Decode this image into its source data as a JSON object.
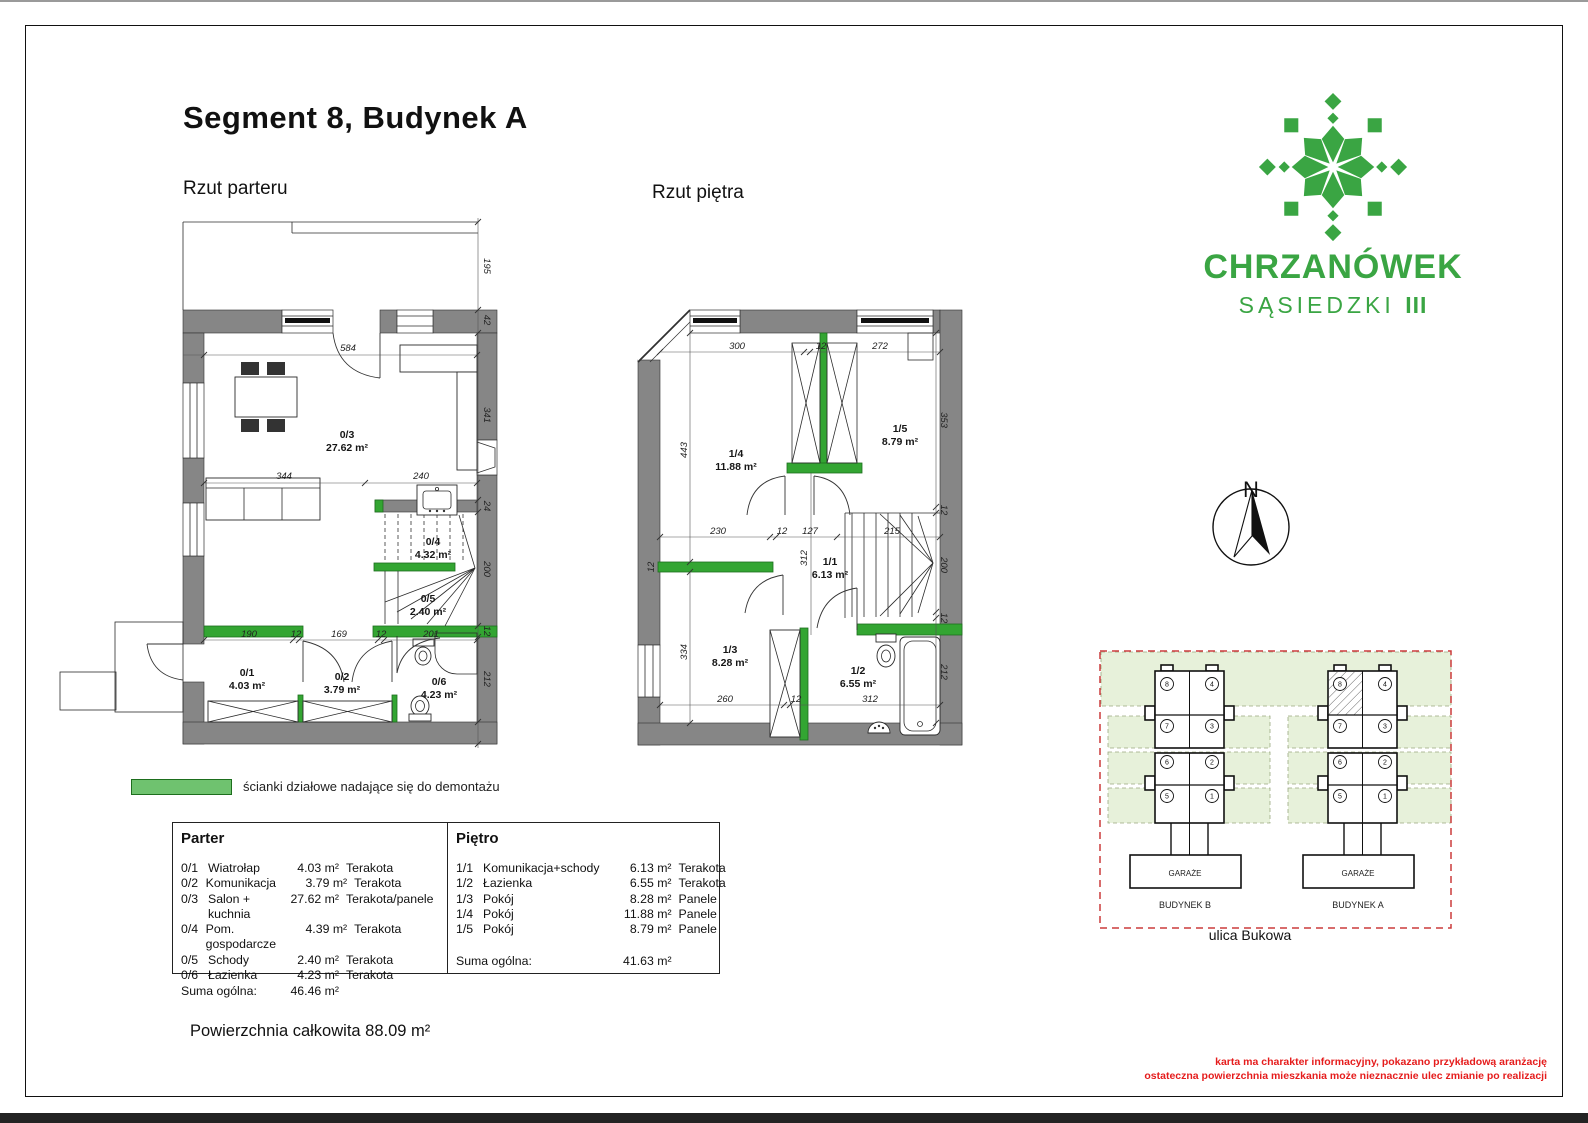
{
  "page": {
    "title": "Segment 8, Budynek A",
    "ground_label": "Rzut parteru",
    "upper_label": "Rzut piętra",
    "legend_text": "ścianki działowe nadające się do demontażu",
    "total_area": "Powierzchnia całkowita 88.09 m²",
    "disclaimer_line1": "karta ma charakter informacyjny, pokazano przykładową aranżację",
    "disclaimer_line2": "ostateczna powierzchnia mieszkania może nieznacznie ulec zmianie po realizacji"
  },
  "logo": {
    "name": "CHRZANÓWEK",
    "sub": "SĄSIEDZKI",
    "roman": "III",
    "green": "#3aa543"
  },
  "compass": {
    "north": "N"
  },
  "site": {
    "building_b": "BUDYNEK B",
    "building_a": "BUDYNEK A",
    "garage_label": "GARAŻE",
    "street": "ulica Bukowa",
    "units": [
      "8",
      "4",
      "7",
      "3",
      "6",
      "2",
      "5",
      "1"
    ]
  },
  "tables": {
    "parter": {
      "header": "Parter",
      "rows": [
        {
          "id": "0/1",
          "name": "Wiatrołap",
          "area": "4.03 m²",
          "floor": "Terakota"
        },
        {
          "id": "0/2",
          "name": "Komunikacja",
          "area": "3.79 m²",
          "floor": "Terakota"
        },
        {
          "id": "0/3",
          "name": "Salon + kuchnia",
          "area": "27.62 m²",
          "floor": "Terakota/panele"
        },
        {
          "id": "0/4",
          "name": "Pom. gospodarcze",
          "area": "4.39 m²",
          "floor": "Terakota"
        },
        {
          "id": "0/5",
          "name": "Schody",
          "area": "2.40 m²",
          "floor": "Terakota"
        },
        {
          "id": "0/6",
          "name": "Łazienka",
          "area": "4.23 m²",
          "floor": "Terakota"
        }
      ],
      "sum_label": "Suma ogólna:",
      "sum_value": "46.46 m²"
    },
    "pietro": {
      "header": "Piętro",
      "rows": [
        {
          "id": "1/1",
          "name": "Komunikacja+schody",
          "area": "6.13 m²",
          "floor": "Terakota"
        },
        {
          "id": "1/2",
          "name": "Łazienka",
          "area": "6.55 m²",
          "floor": "Terakota"
        },
        {
          "id": "1/3",
          "name": "Pokój",
          "area": "8.28 m²",
          "floor": "Panele"
        },
        {
          "id": "1/4",
          "name": "Pokój",
          "area": "11.88 m²",
          "floor": "Panele"
        },
        {
          "id": "1/5",
          "name": "Pokój",
          "area": "8.79 m²",
          "floor": "Panele"
        }
      ],
      "sum_label": "Suma ogólna:",
      "sum_value": "41.63 m²"
    }
  },
  "ground": {
    "rooms": {
      "r03": {
        "id": "0/3",
        "area": "27.62 m²"
      },
      "r04": {
        "id": "0/4",
        "area": "4.32 m²"
      },
      "r05": {
        "id": "0/5",
        "area": "2.40 m²"
      },
      "r01": {
        "id": "0/1",
        "area": "4.03 m²"
      },
      "r02": {
        "id": "0/2",
        "area": "3.79 m²"
      },
      "r06": {
        "id": "0/6",
        "area": "4.23 m²"
      }
    },
    "dims": {
      "h584": "584",
      "h344": "344",
      "h240": "240",
      "h190": "190",
      "h12a": "12",
      "h169": "169",
      "h12b": "12",
      "h201": "201",
      "v195": "195",
      "v42": "42",
      "v341": "341",
      "v24": "24",
      "v200": "200",
      "v12": "12",
      "v212": "212"
    }
  },
  "upper": {
    "rooms": {
      "r14": {
        "id": "1/4",
        "area": "11.88 m²"
      },
      "r15": {
        "id": "1/5",
        "area": "8.79 m²"
      },
      "r11": {
        "id": "1/1",
        "area": "6.13 m²"
      },
      "r13": {
        "id": "1/3",
        "area": "8.28 m²"
      },
      "r12": {
        "id": "1/2",
        "area": "6.55 m²"
      }
    },
    "dims": {
      "t300": "300",
      "t12": "12",
      "t272": "272",
      "m230": "230",
      "m12": "12",
      "m127": "127",
      "m215": "215",
      "b260": "260",
      "b12": "12",
      "b312": "312",
      "l443": "443",
      "l12": "12",
      "l334": "334",
      "c312": "312",
      "r353": "353",
      "r12a": "12",
      "r200": "200",
      "r12b": "12",
      "r212": "212"
    }
  }
}
